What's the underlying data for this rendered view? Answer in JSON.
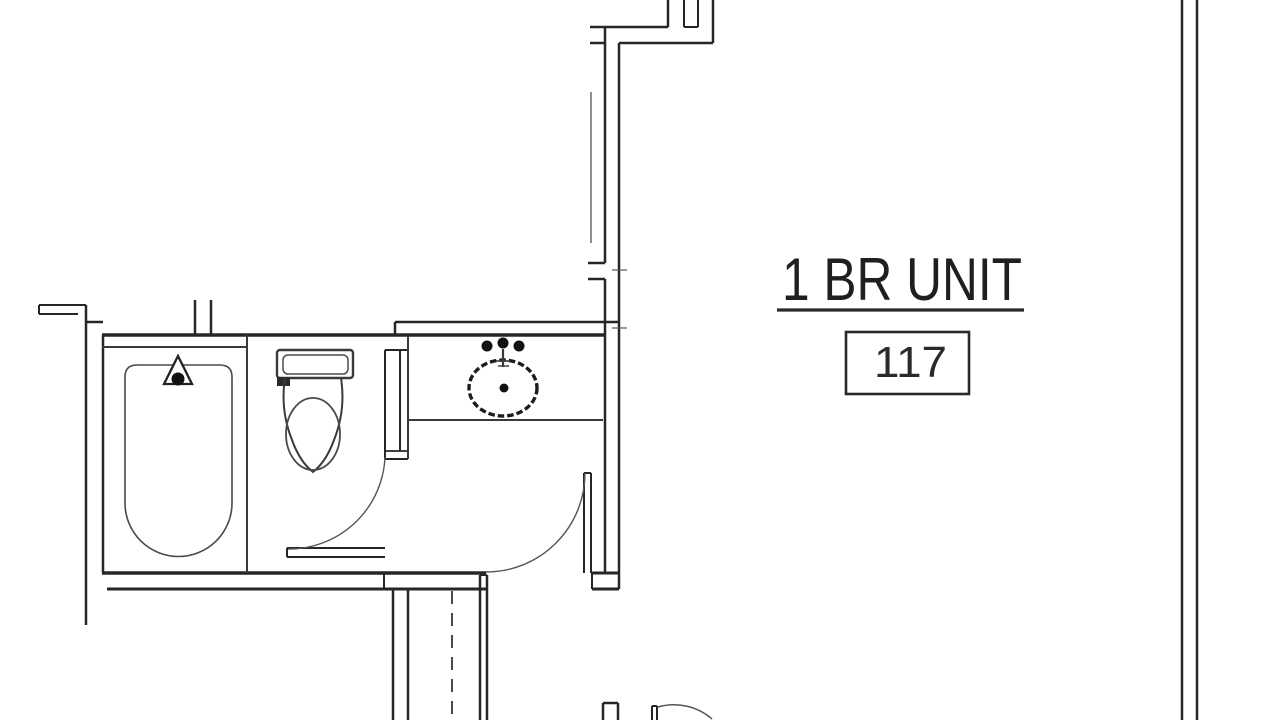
{
  "drawing": {
    "title": "1 BR UNIT",
    "unit_number": "117"
  },
  "colors": {
    "line": "#262626",
    "thin_line": "#555555",
    "text": "#1f1f1f",
    "background": "#ffffff"
  }
}
